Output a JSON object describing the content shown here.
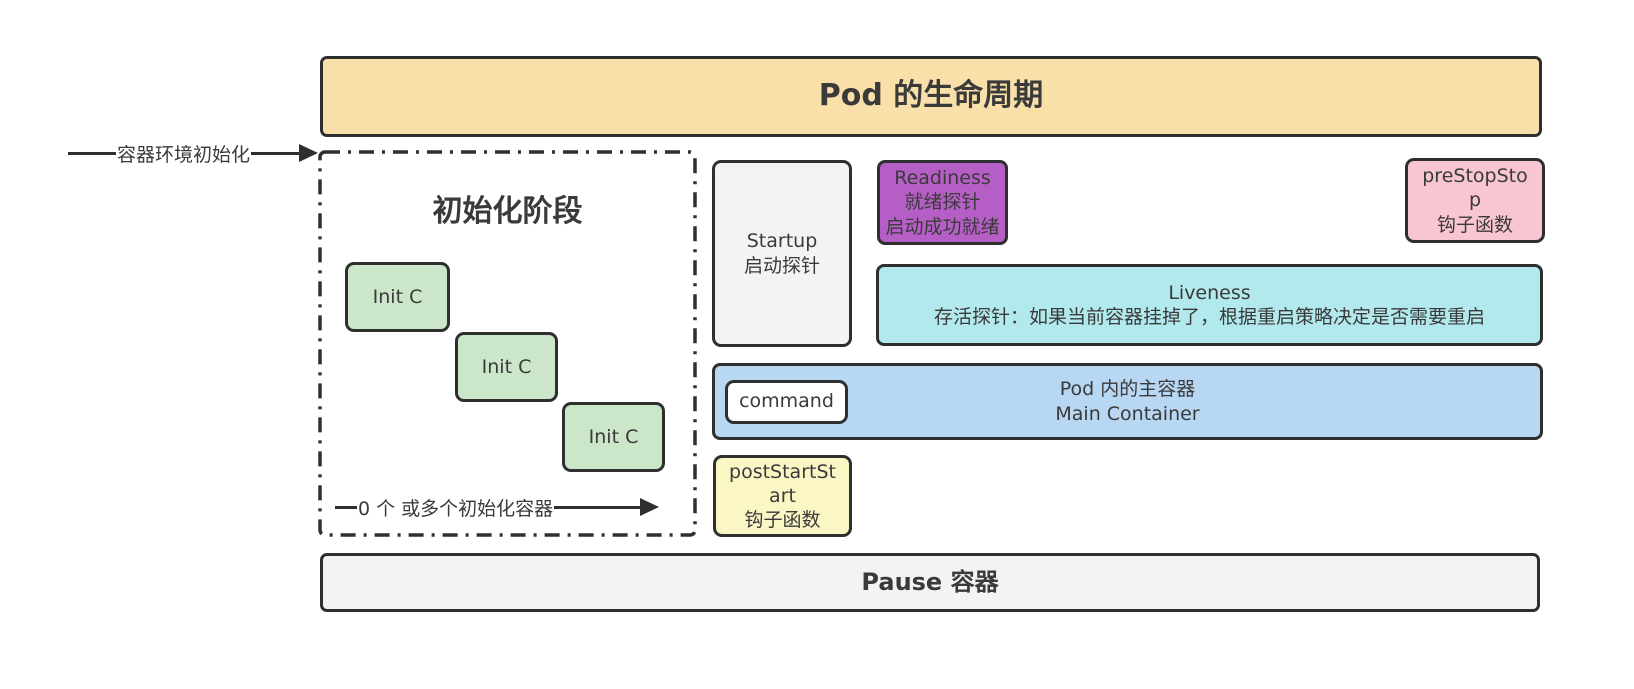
{
  "title": "Pod 的生命周期",
  "arrows": {
    "env_init": "容器环境初始化",
    "init_count": "0 个 或多个初始化容器"
  },
  "init_phase": {
    "heading": "初始化阶段",
    "containers": [
      {
        "label": "Init C"
      },
      {
        "label": "Init C"
      },
      {
        "label": "Init C"
      }
    ]
  },
  "startup_probe": {
    "name": "Startup",
    "desc": "启动探针"
  },
  "readiness_probe": {
    "name": "Readiness",
    "desc": "就绪探针",
    "note": "启动成功就绪"
  },
  "liveness_probe": {
    "name": "Liveness",
    "desc": "存活探针：如果当前容器挂掉了，根据重启策略决定是否需要重启"
  },
  "pre_stop_hook": {
    "name": "preStopStop",
    "desc": "钩子函数"
  },
  "post_start_hook": {
    "name": "postStartStart",
    "desc": "钩子函数"
  },
  "main_container": {
    "command_label": "command",
    "title_zh": "Pod 内的主容器",
    "title_en": "Main Container"
  },
  "pause_container": "Pause 容器",
  "colors": {
    "title_bg": "#F8E0A8",
    "init_container_bg": "#CBE6C8",
    "startup_bg": "#F3F3F1",
    "readiness_bg": "#B55FC6",
    "liveness_bg": "#B2E9ED",
    "pre_stop_bg": "#F8C6D1",
    "post_start_bg": "#FAF7C5",
    "main_container_bg": "#B7D7F2",
    "command_bg": "#FFFFFF",
    "pause_bg": "#F3F3F1",
    "border": "#2F2F2F",
    "text": "#3A3A3A"
  }
}
